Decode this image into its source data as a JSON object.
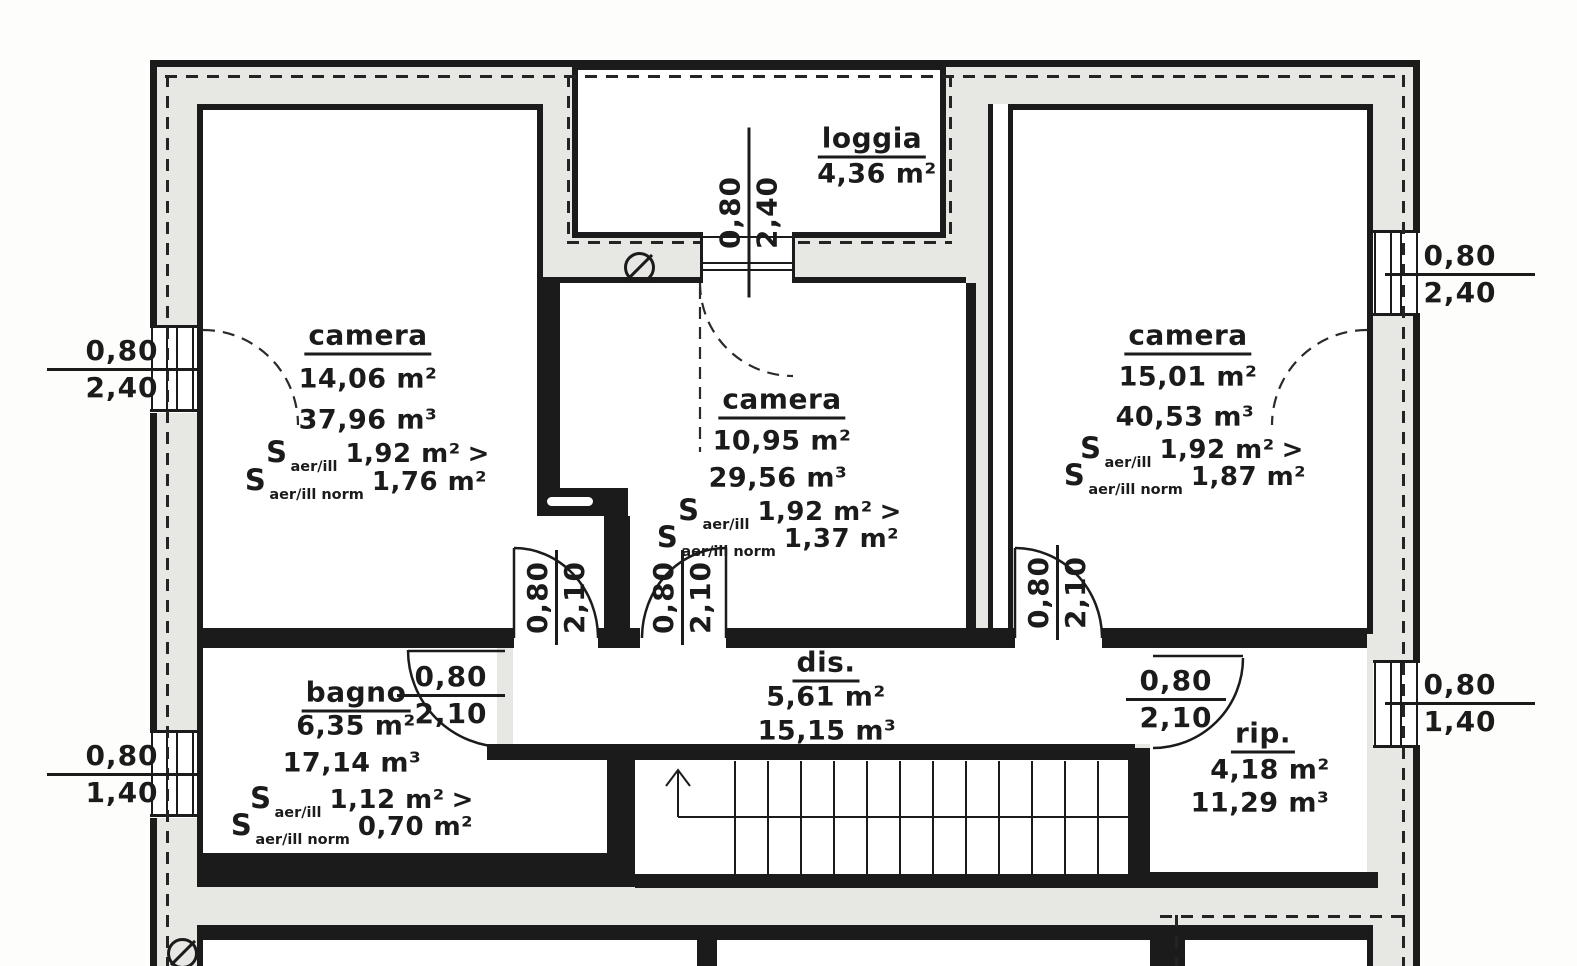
{
  "rooms": {
    "loggia": {
      "name": "loggia",
      "area": "4,36 m²"
    },
    "camera_left": {
      "name": "camera",
      "area": "14,06 m²",
      "volume": "37,96 m³",
      "s_value": "1,92 m²",
      "s_norm": "1,76 m²"
    },
    "camera_middle": {
      "name": "camera",
      "area": "10,95 m²",
      "volume": "29,56 m³",
      "s_value": "1,92 m²",
      "s_norm": "1,37 m²"
    },
    "camera_right": {
      "name": "camera",
      "area": "15,01 m²",
      "volume": "40,53 m³",
      "s_value": "1,92 m²",
      "s_norm": "1,87 m²"
    },
    "bagno": {
      "name": "bagno",
      "area": "6,35 m²",
      "volume": "17,14 m³",
      "s_value": "1,12 m²",
      "s_norm": "0,70 m²"
    },
    "disimpegno": {
      "name": "dis.",
      "area": "5,61 m²",
      "volume": "15,15 m³"
    },
    "ripostiglio": {
      "name": "rip.",
      "area": "4,18 m²",
      "volume": "11,29 m³"
    }
  },
  "formula": {
    "symbol": "S",
    "sub_aer": "aer/ill",
    "sub_norm": "aer/ill norm",
    "greater": ">"
  },
  "dimensions": {
    "window_left_upper": {
      "width": "0,80",
      "height": "2,40"
    },
    "window_left_lower": {
      "width": "0,80",
      "height": "1,40"
    },
    "window_right_upper": {
      "width": "0,80",
      "height": "2,40"
    },
    "window_right_lower": {
      "width": "0,80",
      "height": "1,40"
    },
    "loggia_door": {
      "width": "0,80",
      "height": "2,40"
    },
    "door_camera_left": {
      "width": "0,80",
      "height": "2,10"
    },
    "door_camera_middle": {
      "width": "0,80",
      "height": "2,10"
    },
    "door_camera_right": {
      "width": "0,80",
      "height": "2,10"
    },
    "door_bagno": {
      "width": "0,80",
      "height": "2,10"
    },
    "door_ripostiglio": {
      "width": "0,80",
      "height": "2,10"
    }
  },
  "symbols": {
    "slashed_circle": "∅"
  }
}
